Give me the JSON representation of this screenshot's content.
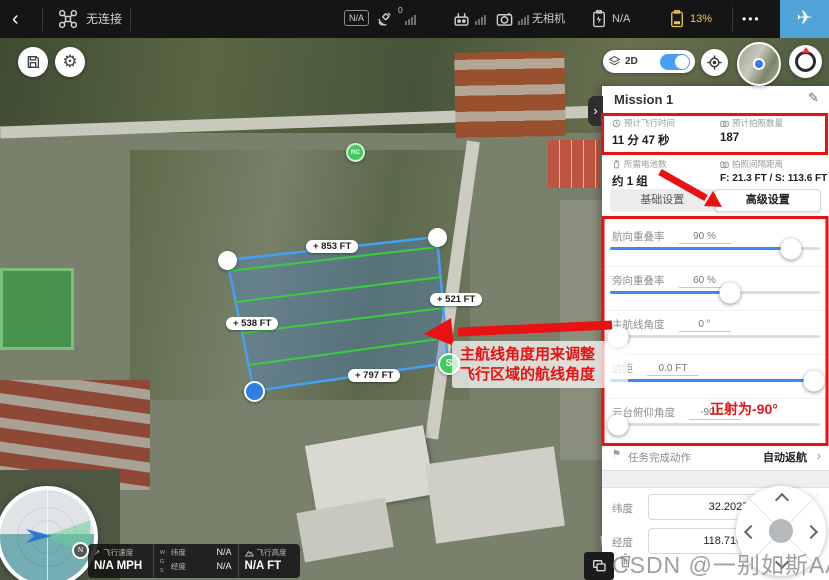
{
  "top_bar": {
    "back_label": "‹",
    "connection_status": "无连接",
    "flight_mode_badge": "N/A",
    "gps_count": "0",
    "camera_status": "无相机",
    "rc_battery_value": "N/A",
    "battery_percent": "13%",
    "more_label": "•••"
  },
  "icons": {
    "plane": "✈",
    "gear": "⚙",
    "pencil": "✎",
    "flag": "⚑",
    "chevron_right": "›",
    "speed_arrow": "↗"
  },
  "map_controls": {
    "view_toggle_label": "2D"
  },
  "map": {
    "edge_labels": [
      {
        "text": "+ 853 FT"
      },
      {
        "text": "+ 521 FT"
      },
      {
        "text": "+ 538 FT"
      },
      {
        "text": "+ 797 FT"
      }
    ],
    "rc_marker_label": "RC",
    "start_marker_label": "S",
    "annotation": {
      "line1": "主航线角度用来调整",
      "line2": "飞行区域的航线角度"
    }
  },
  "panel": {
    "title": "Mission 1",
    "stats": [
      {
        "label": "预计飞行时间",
        "value": "11 分 47 秒"
      },
      {
        "label": "预计拍照数量",
        "value": "187"
      },
      {
        "label": "所需电池数",
        "value": "约 1 组"
      },
      {
        "label": "拍照间隔距离",
        "value": "F: 21.3 FT / S: 113.6 FT"
      }
    ],
    "tabs": [
      {
        "label": "基础设置",
        "active": false
      },
      {
        "label": "高级设置",
        "active": true
      }
    ],
    "sliders": [
      {
        "label": "航向重叠率",
        "value": "90 %",
        "pos": "86%"
      },
      {
        "label": "旁向重叠率",
        "value": "60 %",
        "pos": "57%"
      },
      {
        "label": "主航线角度",
        "value": "0 °",
        "pos": "4%"
      },
      {
        "label": "边距",
        "value": "0.0 FT",
        "pos": "97%"
      },
      {
        "label": "云台俯仰角度",
        "value": "-90.0 °",
        "pos": "4%"
      }
    ],
    "gimbal_note": "正射为-90°",
    "finish_action": {
      "label": "任务完成动作",
      "value": "自动返航"
    },
    "coordinates": {
      "lat_label": "纬度",
      "lat_value": "32.202764195",
      "lng_label": "经度",
      "lng_value": "118.716763493"
    }
  },
  "telemetry": {
    "speed_label": "飞行速度",
    "speed_value": "N/A MPH",
    "crs": "WGS",
    "lat_label": "纬度",
    "lat_value": "N/A",
    "lng_label": "经度",
    "lng_value": "N/A",
    "alt_label": "飞行高度",
    "alt_value": "N/A FT"
  },
  "compass_n": "N",
  "watermark": "CSDN @一别如斯AA",
  "colors": {
    "accent_blue": "#3d8bf2",
    "annotation_red": "#e81212",
    "battery_warning": "#e8c84b",
    "polygon_stroke": "#45a0f5",
    "survey_line_green": "#35d03a",
    "marker_green": "#3ecb5f",
    "takeoff_button_blue": "#4fa3d6"
  }
}
